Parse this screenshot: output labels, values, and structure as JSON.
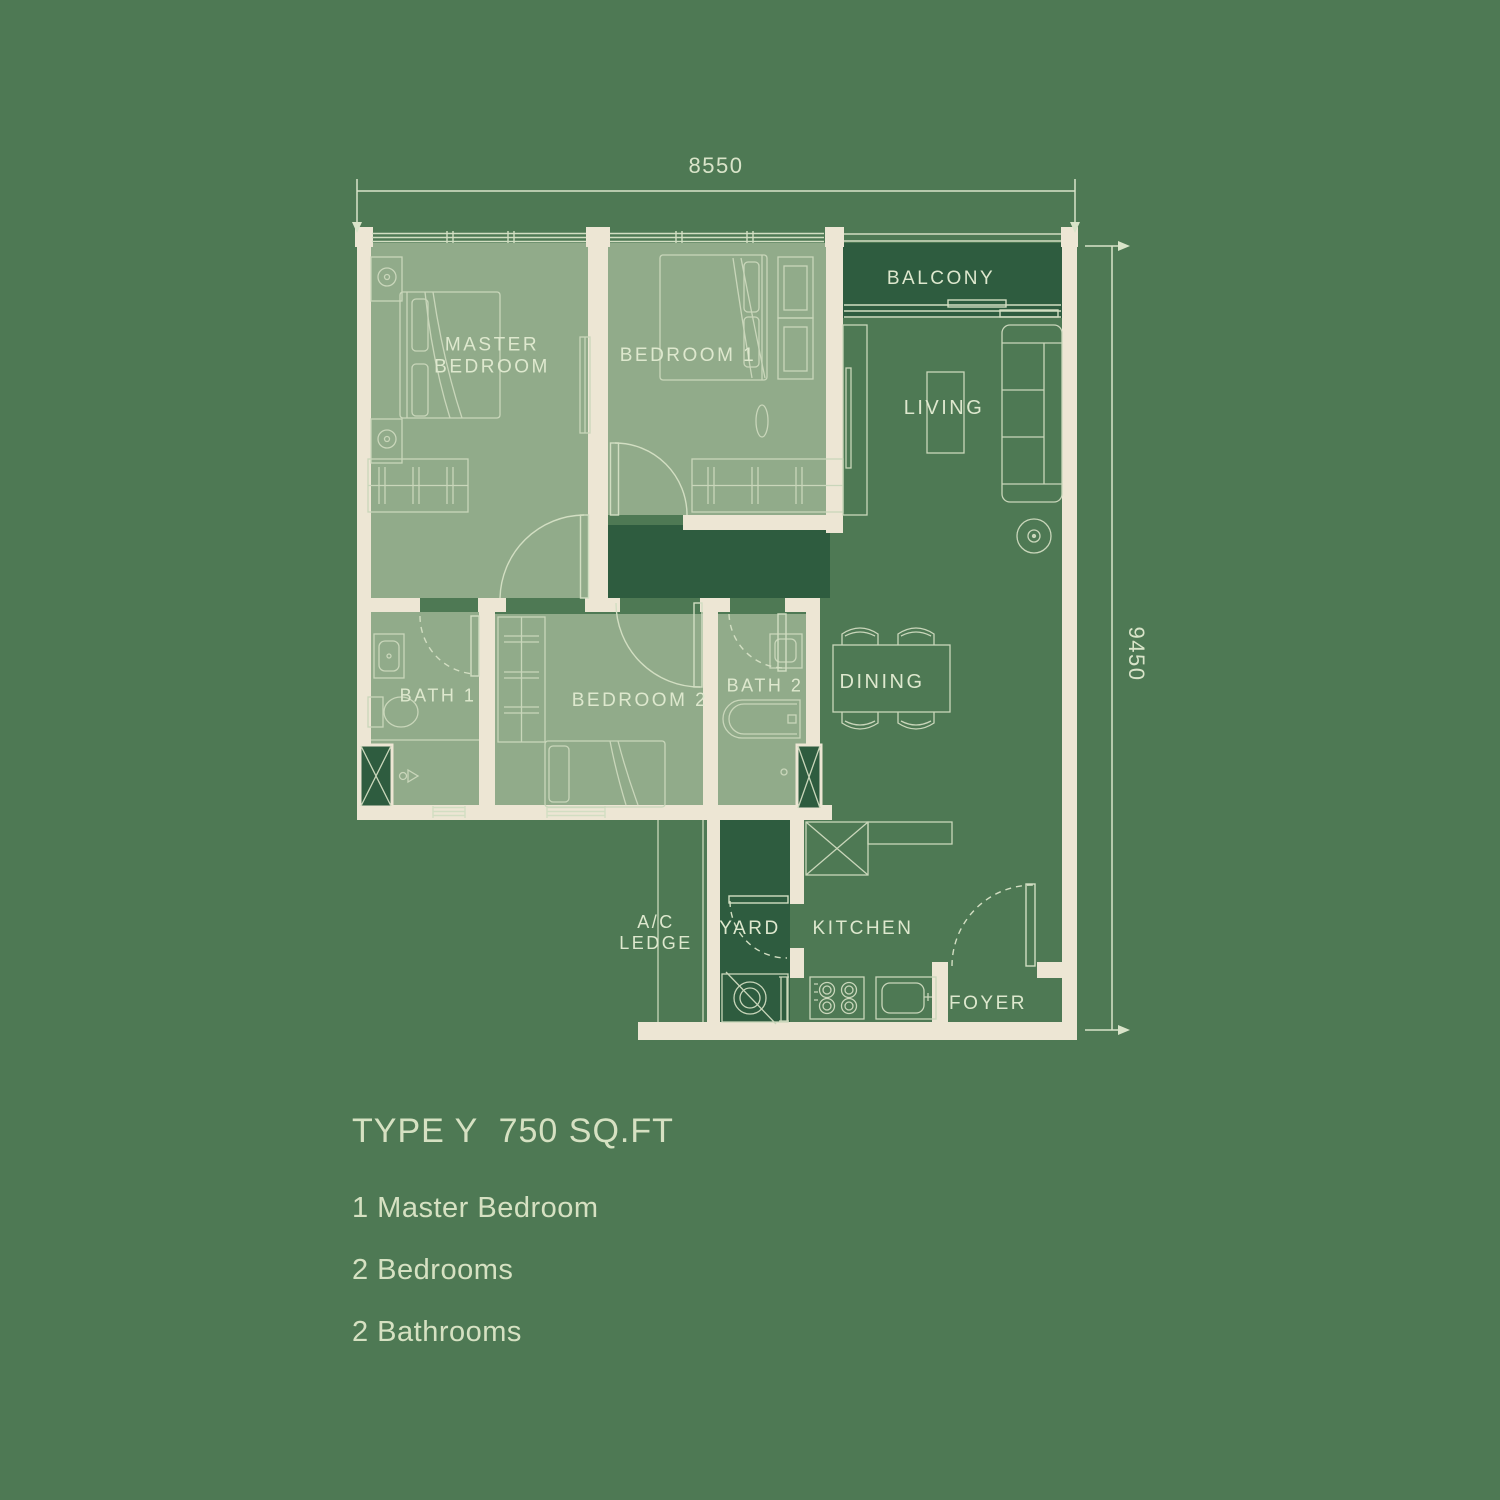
{
  "colors": {
    "background": "#4E7954",
    "room_fill": "#91AB8A",
    "dark_fill": "#2E5C3F",
    "wall": "#EDE6D4",
    "linework": "#D2DEC2",
    "label_text": "#DEE8CE",
    "info_text": "#D6E1C2"
  },
  "dimensions": {
    "width": "8550",
    "height": "9450"
  },
  "labels": {
    "master_bedroom": "MASTER\nBEDROOM",
    "bedroom_1": "BEDROOM 1",
    "balcony": "BALCONY",
    "living": "LIVING",
    "bath_1": "BATH 1",
    "bedroom_2": "BEDROOM 2",
    "bath_2": "BATH 2",
    "dining": "DINING",
    "ac_ledge": "A/C\nLEDGE",
    "yard": "YARD",
    "kitchen": "KITCHEN",
    "foyer": "FOYER"
  },
  "info": {
    "title": "TYPE Y  750 SQ.FT",
    "features": [
      "1 Master Bedroom",
      "2 Bedrooms",
      "2 Bathrooms"
    ]
  }
}
